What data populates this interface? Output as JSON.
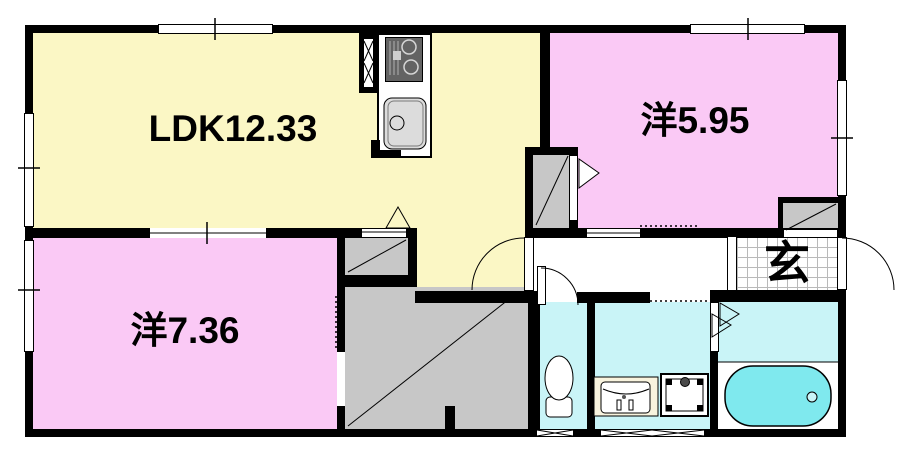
{
  "rooms": {
    "ldk": {
      "label": "LDK12.33"
    },
    "bedroom_a": {
      "label": "洋5.95"
    },
    "bedroom_b": {
      "label": "洋7.36"
    },
    "entrance": {
      "label": "玄"
    }
  },
  "colors": {
    "ldk_fill": "#FBF7C5",
    "bedroom_fill": "#FAC9F5",
    "wet_area_fill": "#C9F4F7",
    "bathtub_fill": "#7FE9EE",
    "closet_fill": "#C7C7C7",
    "wall": "#000000"
  }
}
